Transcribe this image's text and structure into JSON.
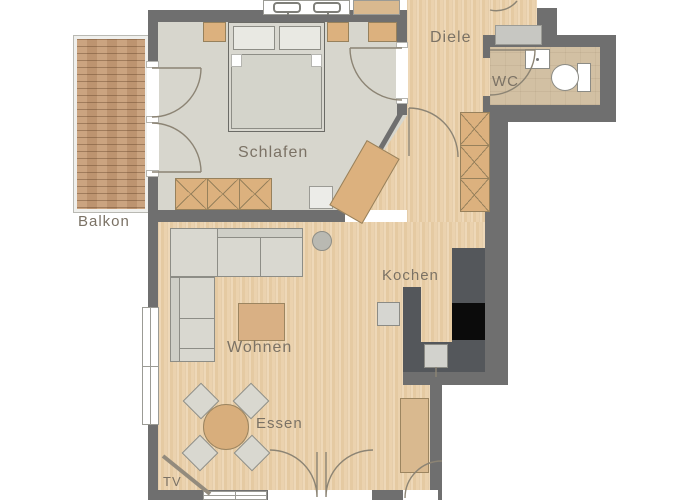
{
  "rooms": {
    "balkon": {
      "label": "Balkon"
    },
    "schlafen": {
      "label": "Schlafen"
    },
    "diele": {
      "label": "Diele"
    },
    "wc": {
      "label": "WC"
    },
    "kochen": {
      "label": "Kochen"
    },
    "wohnen": {
      "label": "Wohnen"
    },
    "essen": {
      "label": "Essen"
    },
    "tv": {
      "label": "TV"
    }
  },
  "colors": {
    "wall": "#6f6f6f",
    "wood_floor": "#e9d0ab",
    "bedroom_floor": "#d7d6cd",
    "wc_floor": "#d2c0a3",
    "balcony_deck": "#c59c77",
    "furniture_tan": "#dcb17e",
    "furniture_gray": "#d9d8d0",
    "kitchen_counter": "#54575b",
    "cooktop": "#0b0b0b",
    "label_text": "#7b7265",
    "door_line": "#8c8474"
  },
  "furniture": [
    "double-bed",
    "pillow",
    "nightstand",
    "wardrobe",
    "desk",
    "stool",
    "pantry-cabinet",
    "hall-cabinet",
    "wash-basin",
    "toilet",
    "kitchen-counter",
    "cooktop",
    "kitchen-sink",
    "appliance",
    "corner-sofa",
    "round-side-table",
    "coffee-table",
    "dining-table",
    "dining-chair",
    "sideboard",
    "tv-board"
  ]
}
